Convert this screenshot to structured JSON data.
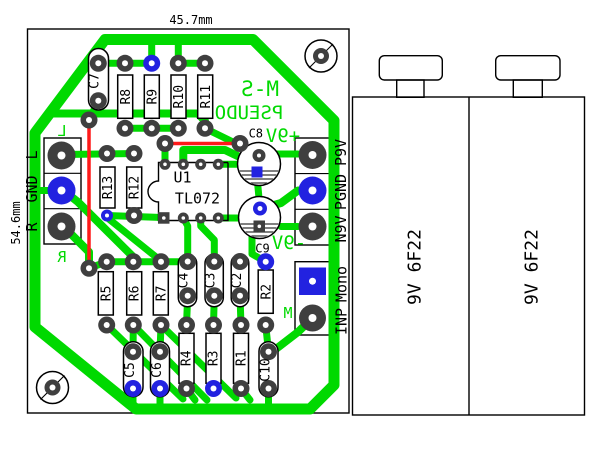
{
  "colors": {
    "trace": "#00d900",
    "silk_green": "#00d900",
    "wire": "#ff1a1a",
    "via": "#2222e0",
    "pad": "#3f3f3f",
    "outline": "#000000",
    "bg": "#ffffff"
  },
  "pcb": {
    "dim_width": "45.7mm",
    "dim_height": "54.6mm",
    "silkscreen": {
      "title_line1": "M-S",
      "title_line2": "PSEUDO",
      "rail_pos": "+9V",
      "rail_neg": "-9V",
      "ch_left": "L",
      "ch_right": "R",
      "mono_mark": "M"
    },
    "ic": {
      "ref": "U1",
      "part": "TL072"
    },
    "resistors": {
      "r1": "R1",
      "r2": "R2",
      "r3": "R3",
      "r4": "R4",
      "r5": "R5",
      "r6": "R6",
      "r7": "R7",
      "r8": "R8",
      "r9": "R9",
      "r10": "R10",
      "r11": "R11",
      "r12": "R12",
      "r13": "R13"
    },
    "capacitors": {
      "c2": "C2",
      "c3": "C3",
      "c4": "C4",
      "c5": "C5",
      "c6": "C6",
      "c7": "C7",
      "c8": "C8",
      "c9": "C9",
      "c10": "C10"
    },
    "connectors": {
      "audio": {
        "l": "L",
        "gnd": "GND",
        "r": "R"
      },
      "power": {
        "pos": "P9V",
        "gnd": "PGND",
        "neg": "N9V"
      },
      "input": {
        "inp": "INP",
        "mono": "Mono"
      }
    }
  },
  "batteries": {
    "cell": "9V 6F22"
  }
}
